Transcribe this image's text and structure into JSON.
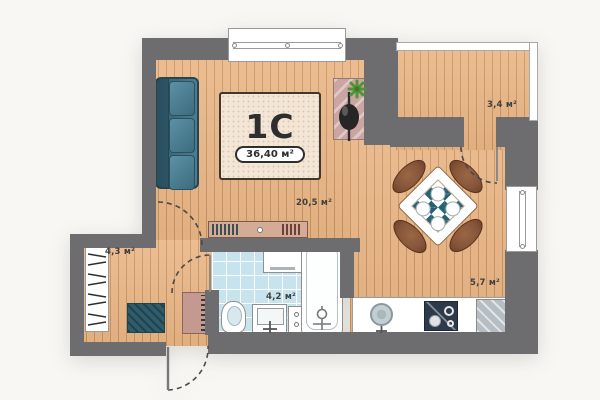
{
  "plan": {
    "unit": {
      "label": "1C",
      "area": "36,40 м²"
    },
    "rooms": [
      {
        "id": "living-dining",
        "area_label": "20,5 м²"
      },
      {
        "id": "kitchen",
        "area_label": "5,7 м²"
      },
      {
        "id": "bathroom",
        "area_label": "4,2 м²"
      },
      {
        "id": "hallway",
        "area_label": "4,3 м²"
      },
      {
        "id": "balcony",
        "area_label": "3,4 м²"
      }
    ],
    "colors": {
      "outside": "#f8f7f4",
      "wall": "#6d6d6f",
      "wood": "#e9b685",
      "woodLine": "#b9834f",
      "tile": "#c6e3ee",
      "sofa": "#4b7d92",
      "sofaDark": "#35606f",
      "teal": "#276273",
      "chair": "#85543a",
      "rug": "#f3e6d6",
      "rugBorder": "#3f3831",
      "ink": "#2e2e2e",
      "label": "#3f3f3f",
      "fixtureLine": "#8f8f8f",
      "stove": "#2c3a4a",
      "glass": "#b6bec4",
      "console": "#cba5a1",
      "plant": "#4f9435",
      "mat": "#2f5c6b",
      "cabinet": "#c49a90",
      "shelf": "#d4ab94"
    }
  }
}
